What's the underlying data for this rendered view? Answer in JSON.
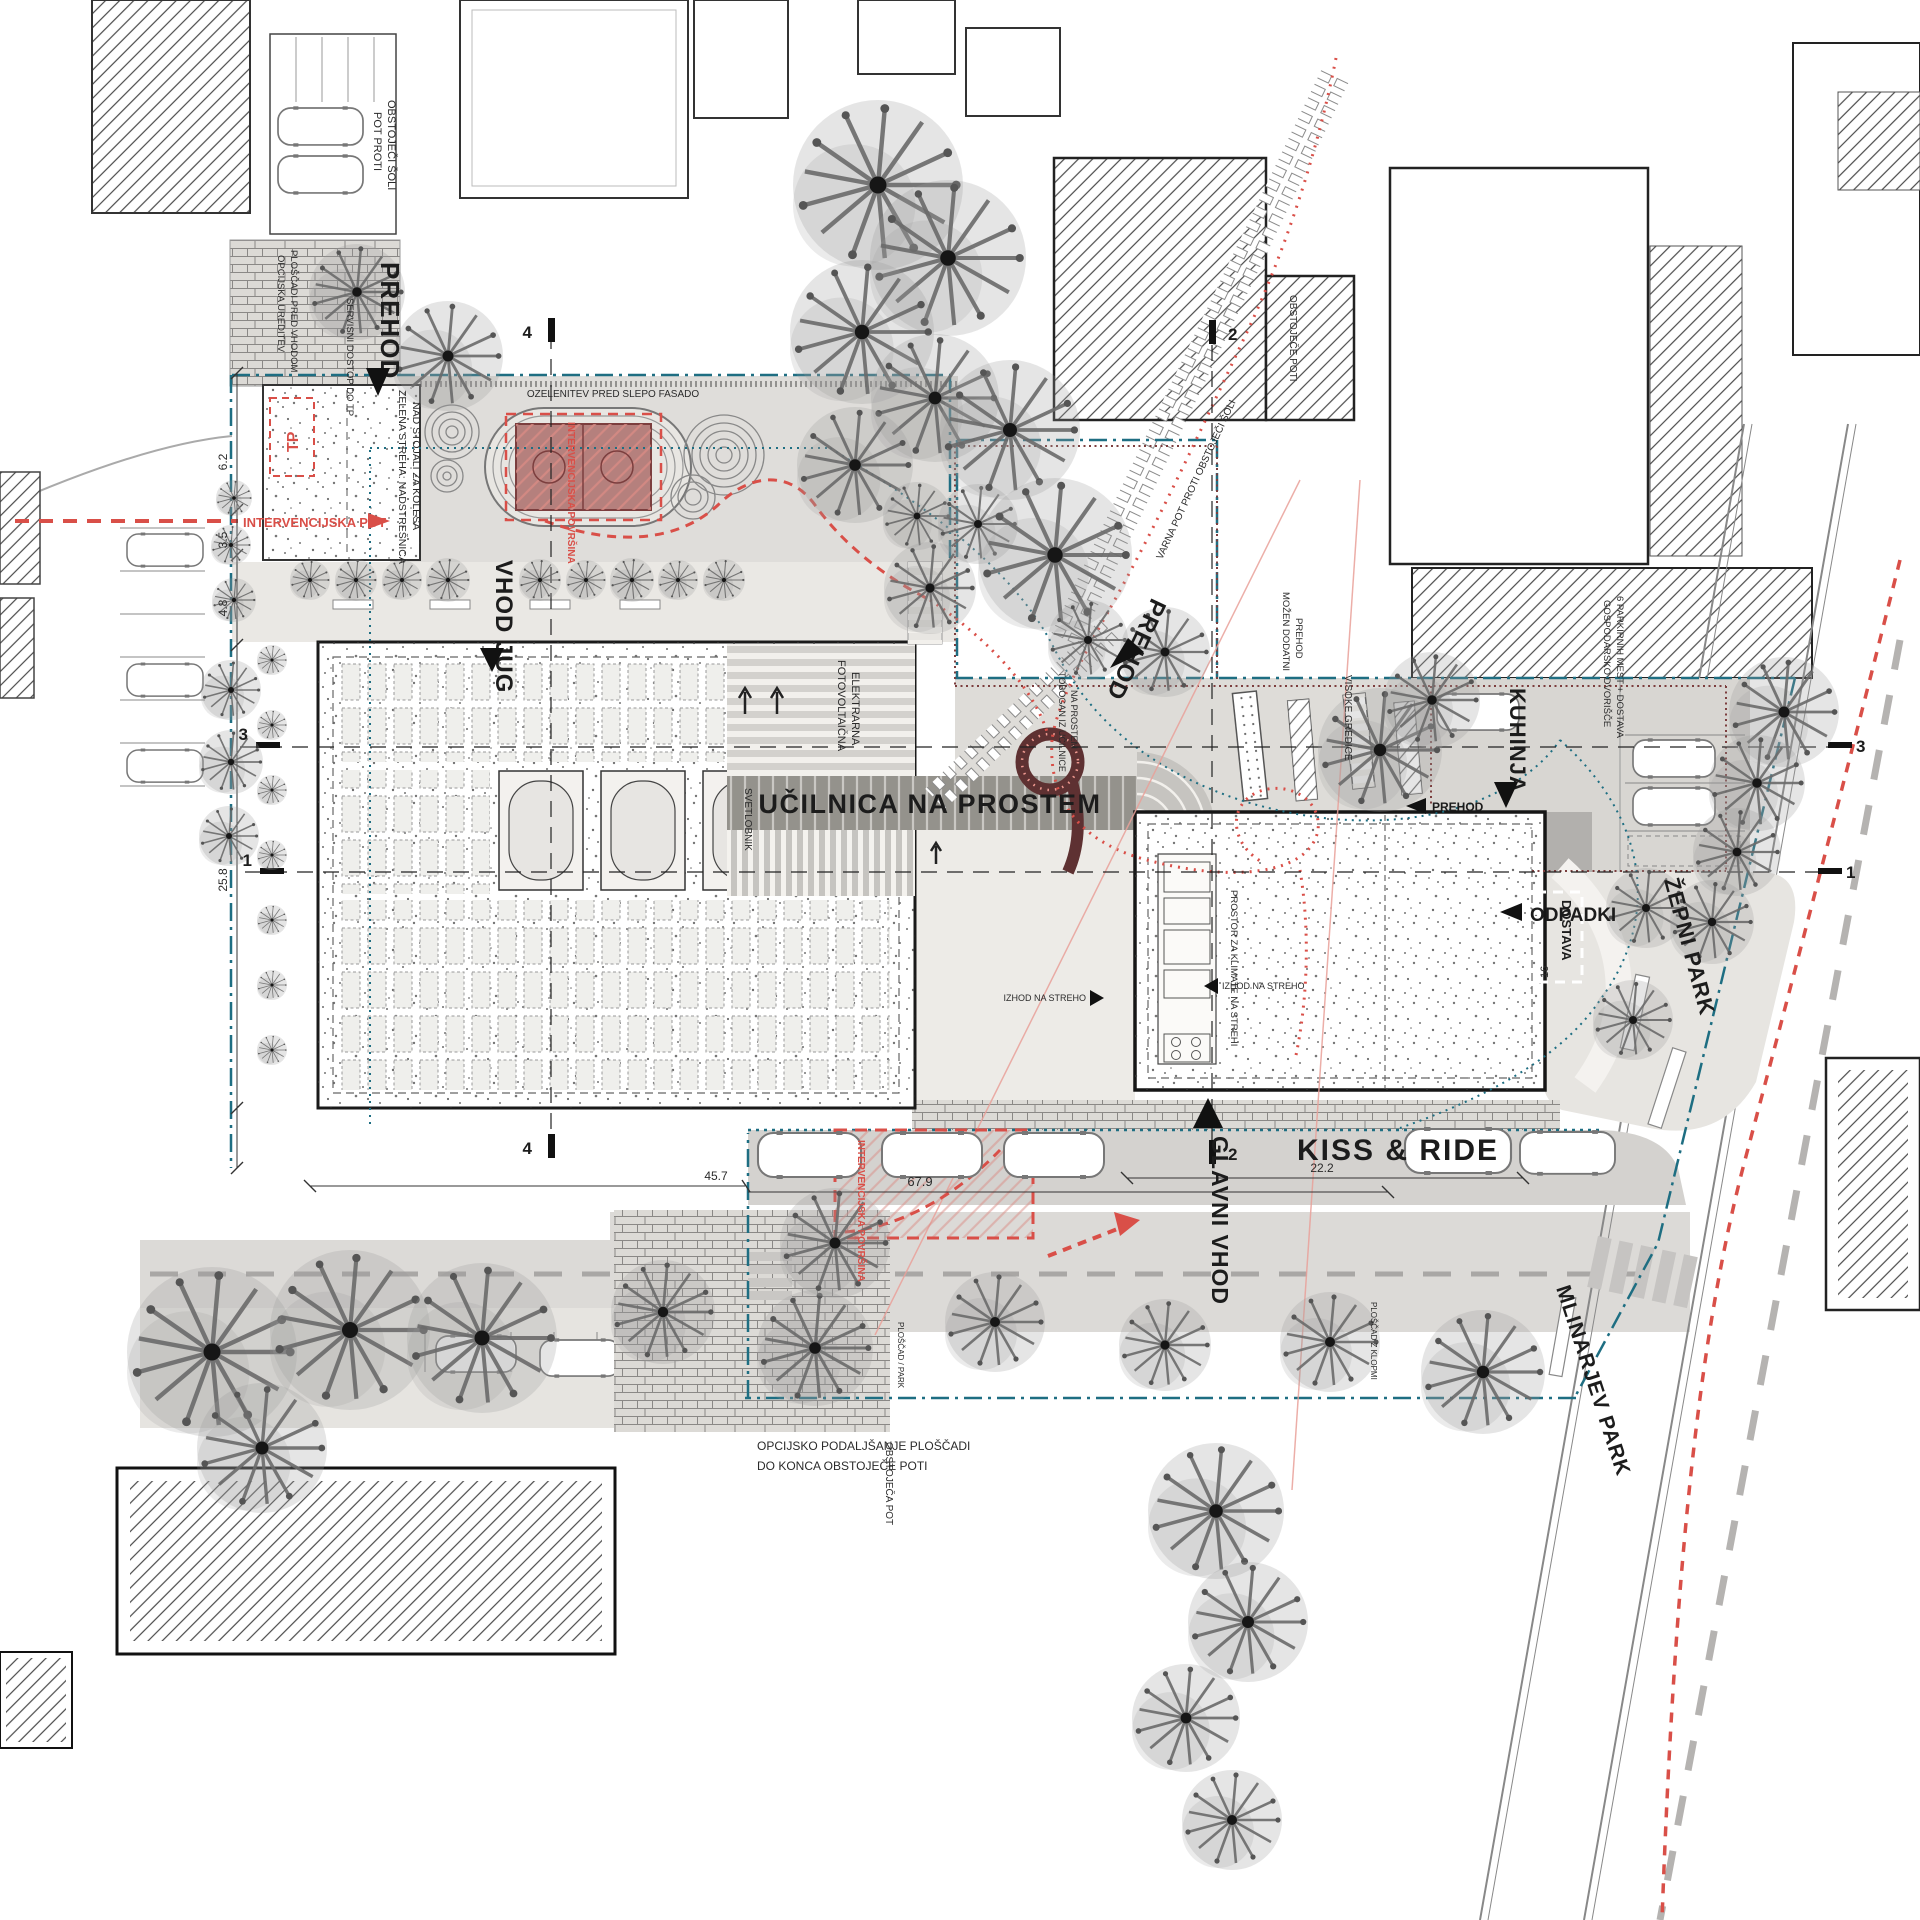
{
  "plan": {
    "labels": {
      "prehod_top": "PREHOD",
      "pot_proti_1": "POT PROTI",
      "pot_proti_2": "OBSTOJEČI ŠOLI",
      "opcijska_1": "OPCIJSKA UREDITEV",
      "opcijska_2": "PLOŠČADI PRED VHODOM",
      "servisni_dostop": "SERVISNI DOSTOP DO TP",
      "tp": "TP",
      "zelena_1": "ZELENA STREHA: NADSTREŠNICA",
      "zelena_2": "NAD STOJALI ZA KOLESA",
      "intervencijska_pot": "INTERVENCIJSKA POT",
      "intervencijska_povrsina": "INTERVENCIJSKA POVRŠINA",
      "vhod_jug": "VHOD JUG",
      "ozelenitev": "OZELENITEV PRED SLEPO FASADO",
      "fotovoltaicna_1": "FOTOVOLTAIČNA",
      "fotovoltaicna_2": "ELEKTRARNA",
      "svetlobnik": "SVETLOBNIK",
      "ucilnica": "UČILNICA NA PROSTEM",
      "tobogan_1": "TOBOGAN IZ UČILNICE",
      "tobogan_2": "NA PROSTEM",
      "prehod_diagonal": "PREHOD",
      "varna_pot": "VARNA POT PROTI OBSTOJEČI ŠOLI",
      "obstojece_poti": "OBSTOJEČE POTI",
      "mozen_1": "MOŽEN DODATNI",
      "mozen_2": "PREHOD",
      "visoke_gredice": "VISOKE GREDICE",
      "kuhinja": "KUHINJA",
      "prehod_small": "PREHOD",
      "gospodarsko_1": "GOSPODARSKO DVORIŠČE",
      "gospodarsko_2": "6 PARKIRNIH MEST + DOSTAVA",
      "odpadki": "ODPADKI",
      "dostava": "DOSTAVA",
      "izhod_na_streho": "IZHOD NA STREHO",
      "prostor_klimate": "PROSTOR ZA KLIMATE NA STREHI",
      "zepni_park": "ŽEPNI PARK",
      "glavni_vhod": "GLAVNI VHOD",
      "kiss_and_ride": "KISS & RIDE",
      "mlinarjev_park": "MLINARJEV PARK",
      "opcijsko_1": "OPCIJSKO PODALJŠANJE PLOŠČADI",
      "opcijsko_2": "DO KONCA OBSTOJEČE POTI",
      "obstojeca_pot": "OBSTOJEČA POT",
      "ploscad_park": "PLOŠČAD / PARK",
      "ploscad_klopmi": "PLOŠČAD Z KLOPMI"
    },
    "dimensions": {
      "dim_6_2": "6.2",
      "dim_3_5": "3.5",
      "dim_4_8": "4.8",
      "dim_25_8": "25.8",
      "dim_45_7": "45.7",
      "dim_67_9": "67.9",
      "dim_22_2": "22.2",
      "dim_16": "16"
    },
    "section_markers": {
      "m1": "1",
      "m2": "2",
      "m3": "3",
      "m4": "4"
    },
    "colors": {
      "accent_red": "#d94f48",
      "salmon": "#ee7a6e",
      "boundary_teal": "#1e6e82",
      "maroon": "#7c3e3e",
      "court_fill": "#b5807d"
    }
  }
}
